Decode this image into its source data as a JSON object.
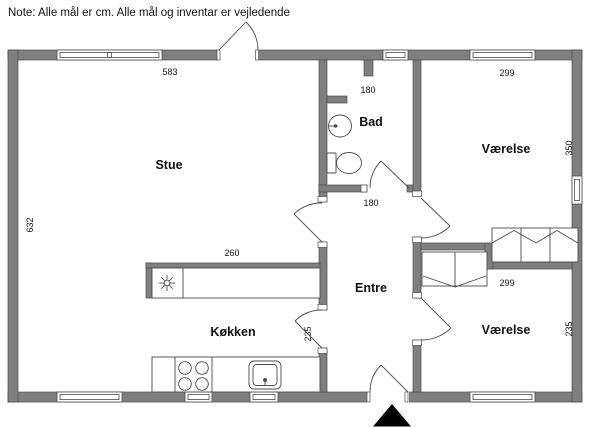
{
  "note": "Note: Alle mål er cm. Alle mål og inventar er vejledende",
  "rooms": {
    "stue": "Stue",
    "bad": "Bad",
    "vaerelse_top": "Værelse",
    "vaerelse_bottom": "Værelse",
    "entre": "Entre",
    "koekken": "Køkken"
  },
  "dimensions": {
    "stue_width_cm": "583",
    "stue_depth_cm": "632",
    "bad_width_cm": "180",
    "entre_width_cm": "180",
    "vaerelse_top_width_cm": "299",
    "vaerelse_top_depth_cm": "350",
    "vaerelse_bottom_width_cm": "299",
    "vaerelse_bottom_depth_cm": "235",
    "koekken_counter_cm": "260",
    "koekken_depth_cm": "235"
  },
  "icons": {
    "north_arrow": "▲",
    "cooktop_star": "✳"
  },
  "colors": {
    "wall_fill": "#7f7f7f",
    "wall_edge": "#4b4b4b",
    "line": "#4b4b4b",
    "background": "#ffffff",
    "north_arrow": "#000000"
  }
}
